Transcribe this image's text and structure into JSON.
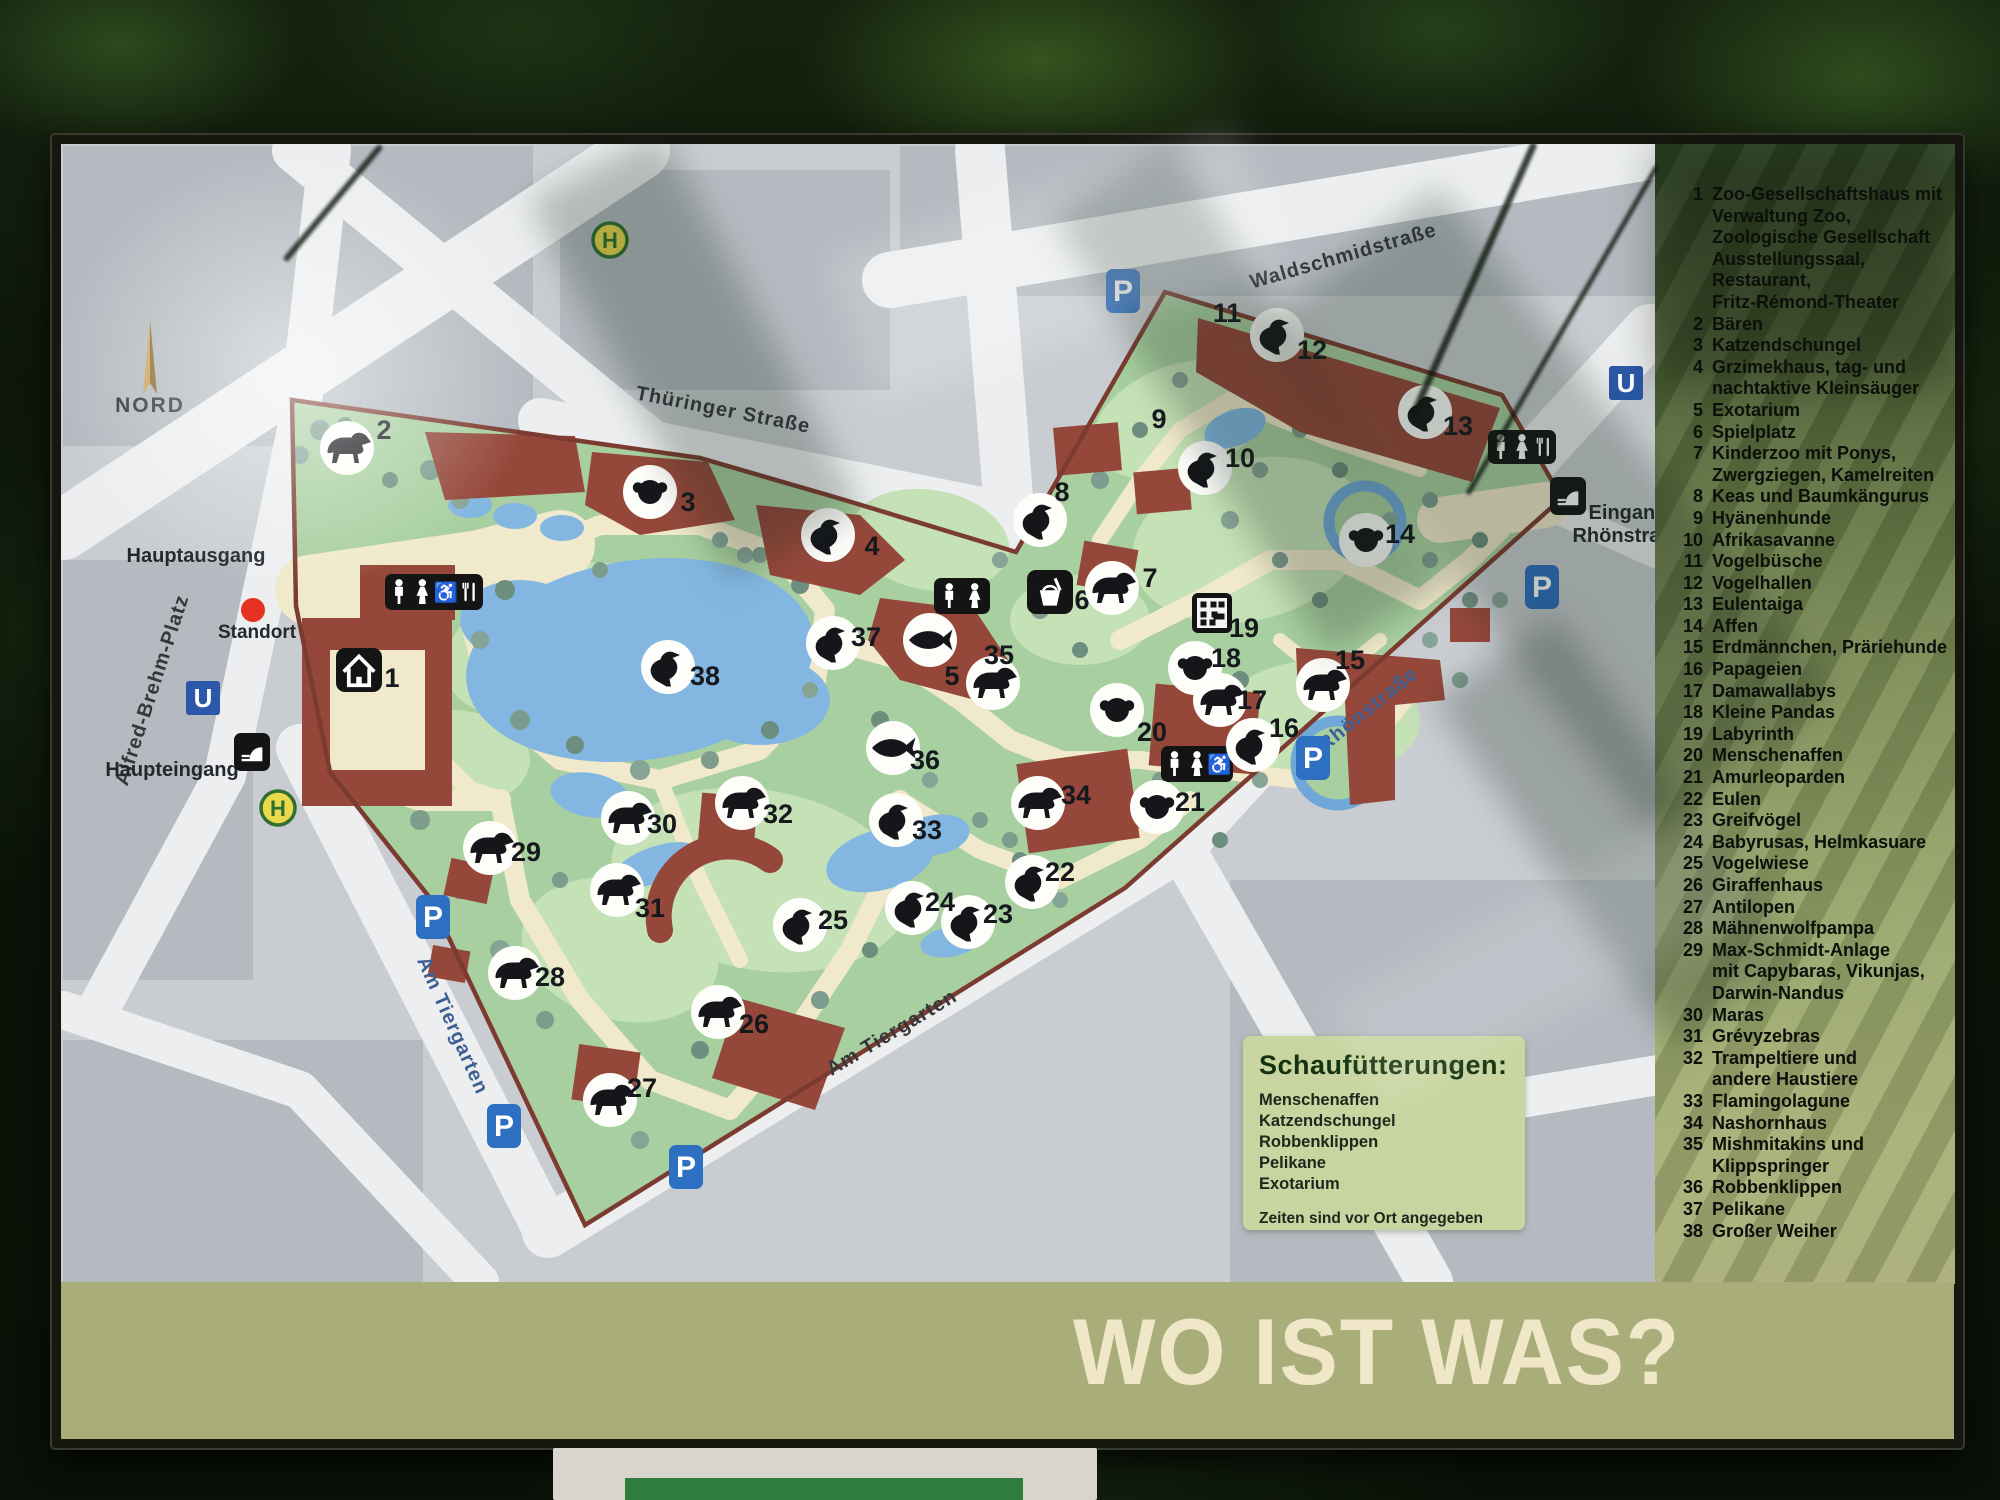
{
  "sign": {
    "banner_title": "WO IST WAS?",
    "legend": {
      "items": [
        {
          "n": "1",
          "lines": [
            "Zoo-Gesellschaftshaus mit",
            "Verwaltung Zoo,",
            "Zoologische Gesellschaft",
            "Ausstellungssaal,",
            "Restaurant,",
            "Fritz-Rémond-Theater"
          ]
        },
        {
          "n": "2",
          "lines": [
            "Bären"
          ]
        },
        {
          "n": "3",
          "lines": [
            "Katzendschungel"
          ]
        },
        {
          "n": "4",
          "lines": [
            "Grzimekhaus, tag- und",
            "nachtaktive Kleinsäuger"
          ]
        },
        {
          "n": "5",
          "lines": [
            "Exotarium"
          ]
        },
        {
          "n": "6",
          "lines": [
            "Spielplatz"
          ]
        },
        {
          "n": "7",
          "lines": [
            "Kinderzoo mit Ponys,",
            "Zwergziegen, Kamelreiten"
          ]
        },
        {
          "n": "8",
          "lines": [
            "Keas und Baumkängurus"
          ]
        },
        {
          "n": "9",
          "lines": [
            "Hyänenhunde"
          ]
        },
        {
          "n": "10",
          "lines": [
            "Afrikasavanne"
          ]
        },
        {
          "n": "11",
          "lines": [
            "Vogelbüsche"
          ]
        },
        {
          "n": "12",
          "lines": [
            "Vogelhallen"
          ]
        },
        {
          "n": "13",
          "lines": [
            "Eulentaiga"
          ]
        },
        {
          "n": "14",
          "lines": [
            "Affen"
          ]
        },
        {
          "n": "15",
          "lines": [
            "Erdmännchen, Präriehunde"
          ]
        },
        {
          "n": "16",
          "lines": [
            "Papageien"
          ]
        },
        {
          "n": "17",
          "lines": [
            "Damawallabys"
          ]
        },
        {
          "n": "18",
          "lines": [
            "Kleine Pandas"
          ]
        },
        {
          "n": "19",
          "lines": [
            "Labyrinth"
          ]
        },
        {
          "n": "20",
          "lines": [
            "Menschenaffen"
          ]
        },
        {
          "n": "21",
          "lines": [
            "Amurleoparden"
          ]
        },
        {
          "n": "22",
          "lines": [
            "Eulen"
          ]
        },
        {
          "n": "23",
          "lines": [
            "Greifvögel"
          ]
        },
        {
          "n": "24",
          "lines": [
            "Babyrusas, Helmkasuare"
          ]
        },
        {
          "n": "25",
          "lines": [
            "Vogelwiese"
          ]
        },
        {
          "n": "26",
          "lines": [
            "Giraffenhaus"
          ]
        },
        {
          "n": "27",
          "lines": [
            "Antilopen"
          ]
        },
        {
          "n": "28",
          "lines": [
            "Mähnenwolfpampa"
          ]
        },
        {
          "n": "29",
          "lines": [
            "Max-Schmidt-Anlage",
            "mit Capybaras, Vikunjas,",
            "Darwin-Nandus"
          ]
        },
        {
          "n": "30",
          "lines": [
            "Maras"
          ]
        },
        {
          "n": "31",
          "lines": [
            "Grévyzebras"
          ]
        },
        {
          "n": "32",
          "lines": [
            "Trampeltiere und",
            "andere Haustiere"
          ]
        },
        {
          "n": "33",
          "lines": [
            "Flamingolagune"
          ]
        },
        {
          "n": "34",
          "lines": [
            "Nashornhaus"
          ]
        },
        {
          "n": "35",
          "lines": [
            "Mishmitakins und",
            "Klippspringer"
          ]
        },
        {
          "n": "36",
          "lines": [
            "Robbenklippen"
          ]
        },
        {
          "n": "37",
          "lines": [
            "Pelikane"
          ]
        },
        {
          "n": "38",
          "lines": [
            "Großer Weiher"
          ]
        }
      ]
    },
    "feeding": {
      "title": "Schaufütterungen:",
      "items": [
        "Menschenaffen",
        "Katzendschungel",
        "Robbenklippen",
        "Pelikane",
        "Exotarium"
      ],
      "note": "Zeiten sind vor Ort angegeben"
    }
  },
  "map": {
    "compass": {
      "label": "NORD",
      "x": 150,
      "y": 412
    },
    "standort": {
      "label": "Standort",
      "x": 253,
      "y": 610
    },
    "entrance_labels": [
      {
        "id": "hauptausgang",
        "text": "Hauptausgang",
        "x": 196,
        "y": 562
      },
      {
        "id": "haupteingang",
        "text": "Haupteingang",
        "x": 172,
        "y": 776
      },
      {
        "id": "eingang-rhoenstrasse-1",
        "text": "Eingang",
        "x": 1628,
        "y": 519
      },
      {
        "id": "eingang-rhoenstrasse-2",
        "text": "Rhönstraße",
        "x": 1628,
        "y": 542
      }
    ],
    "street_labels": [
      {
        "id": "waldschmidstrasse",
        "text": "Waldschmidstraße",
        "x": 1345,
        "y": 262,
        "rot": -16,
        "color": "#34383d"
      },
      {
        "id": "thueringer-strasse",
        "text": "Thüringer Straße",
        "x": 722,
        "y": 416,
        "rot": 11,
        "color": "#34383d"
      },
      {
        "id": "rhoenstrasse",
        "text": "Rhönstraße",
        "x": 1372,
        "y": 714,
        "rot": -39,
        "color": "#3d5f93"
      },
      {
        "id": "am-tiergarten-west",
        "text": "Am Tiergarten",
        "x": 447,
        "y": 1028,
        "rot": 66,
        "color": "#3d5f93"
      },
      {
        "id": "am-tiergarten-sued",
        "text": "Am Tiergarten",
        "x": 895,
        "y": 1038,
        "rot": -31,
        "color": "#34383d"
      },
      {
        "id": "alfred-brehm-platz",
        "text": "Alfred-Brehm-Platz",
        "x": 158,
        "y": 692,
        "rot": -72,
        "color": "#34383d"
      }
    ],
    "markers": [
      {
        "n": "1",
        "icon": "zoo-house-icon",
        "style": "square",
        "x": 359,
        "y": 670,
        "lx": 392,
        "ly": 678
      },
      {
        "n": "2",
        "icon": "bear-icon",
        "x": 347,
        "y": 448,
        "lx": 384,
        "ly": 430
      },
      {
        "n": "3",
        "icon": "tiger-icon",
        "x": 650,
        "y": 492,
        "lx": 688,
        "ly": 502
      },
      {
        "n": "4",
        "icon": "bat-icon",
        "x": 828,
        "y": 535,
        "lx": 872,
        "ly": 546
      },
      {
        "n": "5",
        "icon": "fish-icon",
        "x": 930,
        "y": 640,
        "lx": 952,
        "ly": 676
      },
      {
        "n": "6",
        "icon": "playground-icon",
        "style": "square",
        "x": 1050,
        "y": 592,
        "lx": 1082,
        "ly": 600
      },
      {
        "n": "7",
        "icon": "pony-icon",
        "x": 1112,
        "y": 588,
        "lx": 1150,
        "ly": 578
      },
      {
        "n": "8",
        "icon": "kea-icon",
        "x": 1040,
        "y": 520,
        "lx": 1062,
        "ly": 492
      },
      {
        "n": "9",
        "icon": "wild-dog-icon",
        "style": "number-only",
        "x": 1159,
        "y": 419,
        "lx": 1159,
        "ly": 419
      },
      {
        "n": "10",
        "icon": "ostrich-icon",
        "x": 1205,
        "y": 468,
        "lx": 1240,
        "ly": 458
      },
      {
        "n": "11",
        "icon": "bird-bush-icon",
        "style": "number-only",
        "x": 1227,
        "y": 313,
        "lx": 1227,
        "ly": 313
      },
      {
        "n": "12",
        "icon": "ibis-icon",
        "x": 1277,
        "y": 335,
        "lx": 1312,
        "ly": 350
      },
      {
        "n": "13",
        "icon": "parrot-icon",
        "x": 1425,
        "y": 412,
        "lx": 1458,
        "ly": 426
      },
      {
        "n": "14",
        "icon": "monkey-icon",
        "x": 1366,
        "y": 540,
        "lx": 1400,
        "ly": 534
      },
      {
        "n": "15",
        "icon": "meerkat-icon",
        "x": 1323,
        "y": 685,
        "lx": 1350,
        "ly": 660
      },
      {
        "n": "16",
        "icon": "parrot-icon",
        "x": 1253,
        "y": 745,
        "lx": 1284,
        "ly": 728
      },
      {
        "n": "17",
        "icon": "wallaby-icon",
        "x": 1220,
        "y": 700,
        "lx": 1252,
        "ly": 700
      },
      {
        "n": "18",
        "icon": "red-panda-icon",
        "x": 1195,
        "y": 668,
        "lx": 1226,
        "ly": 658
      },
      {
        "n": "19",
        "icon": "labyrinth-icon",
        "style": "qr",
        "x": 1212,
        "y": 613,
        "lx": 1244,
        "ly": 628
      },
      {
        "n": "20",
        "icon": "gorilla-icon",
        "x": 1117,
        "y": 710,
        "lx": 1152,
        "ly": 732
      },
      {
        "n": "21",
        "icon": "leopard-icon",
        "x": 1157,
        "y": 807,
        "lx": 1190,
        "ly": 802
      },
      {
        "n": "22",
        "icon": "owl-icon",
        "x": 1032,
        "y": 882,
        "lx": 1060,
        "ly": 872
      },
      {
        "n": "23",
        "icon": "falcon-icon",
        "x": 968,
        "y": 922,
        "lx": 998,
        "ly": 914
      },
      {
        "n": "24",
        "icon": "cassowary-icon",
        "x": 912,
        "y": 908,
        "lx": 940,
        "ly": 902
      },
      {
        "n": "25",
        "icon": "crane-icon",
        "x": 800,
        "y": 925,
        "lx": 833,
        "ly": 920
      },
      {
        "n": "26",
        "icon": "giraffe-icon",
        "x": 718,
        "y": 1012,
        "lx": 754,
        "ly": 1024
      },
      {
        "n": "27",
        "icon": "antelope-icon",
        "x": 610,
        "y": 1100,
        "lx": 642,
        "ly": 1088
      },
      {
        "n": "28",
        "icon": "maned-wolf-icon",
        "x": 515,
        "y": 973,
        "lx": 550,
        "ly": 977
      },
      {
        "n": "29",
        "icon": "vicuna-icon",
        "x": 490,
        "y": 848,
        "lx": 526,
        "ly": 852
      },
      {
        "n": "30",
        "icon": "mara-icon",
        "x": 628,
        "y": 818,
        "lx": 662,
        "ly": 824
      },
      {
        "n": "31",
        "icon": "zebra-icon",
        "x": 617,
        "y": 890,
        "lx": 650,
        "ly": 908
      },
      {
        "n": "32",
        "icon": "camel-icon",
        "x": 742,
        "y": 803,
        "lx": 778,
        "ly": 814
      },
      {
        "n": "33",
        "icon": "flamingo-icon",
        "x": 896,
        "y": 820,
        "lx": 927,
        "ly": 830
      },
      {
        "n": "34",
        "icon": "rhino-icon",
        "x": 1038,
        "y": 803,
        "lx": 1076,
        "ly": 795
      },
      {
        "n": "35",
        "icon": "tapir-icon",
        "x": 993,
        "y": 683,
        "lx": 999,
        "ly": 655
      },
      {
        "n": "36",
        "icon": "seal-icon",
        "x": 893,
        "y": 748,
        "lx": 925,
        "ly": 760
      },
      {
        "n": "37",
        "icon": "pelican-icon",
        "x": 833,
        "y": 643,
        "lx": 866,
        "ly": 637
      },
      {
        "n": "38",
        "icon": "swan-icon",
        "x": 668,
        "y": 667,
        "lx": 705,
        "ly": 676
      }
    ],
    "facilities": [
      {
        "id": "wc-restaurant-main",
        "x": 385,
        "y": 574,
        "w": 98,
        "h": 36,
        "glyphs": [
          "man",
          "woman",
          "wheel",
          "fork"
        ]
      },
      {
        "id": "wc-exotarium",
        "x": 934,
        "y": 578,
        "w": 56,
        "h": 36,
        "glyphs": [
          "man",
          "woman"
        ]
      },
      {
        "id": "wc-sued",
        "x": 1161,
        "y": 746,
        "w": 72,
        "h": 36,
        "glyphs": [
          "man",
          "woman",
          "wheel"
        ]
      },
      {
        "id": "wc-restaurant-ost",
        "x": 1488,
        "y": 430,
        "w": 68,
        "h": 34,
        "glyphs": [
          "man",
          "woman",
          "fork"
        ]
      },
      {
        "id": "tor-ost",
        "x": 1550,
        "y": 477,
        "w": 36,
        "h": 38,
        "glyphs": [
          "gate"
        ]
      },
      {
        "id": "tor-haupteingang",
        "x": 234,
        "y": 733,
        "w": 36,
        "h": 38,
        "glyphs": [
          "gate"
        ]
      }
    ],
    "transit": [
      {
        "type": "P",
        "x": 1123,
        "y": 291
      },
      {
        "type": "P",
        "x": 433,
        "y": 917
      },
      {
        "type": "P",
        "x": 504,
        "y": 1126
      },
      {
        "type": "P",
        "x": 686,
        "y": 1167
      },
      {
        "type": "P",
        "x": 1313,
        "y": 758
      },
      {
        "type": "P",
        "x": 1542,
        "y": 587
      },
      {
        "type": "U",
        "x": 203,
        "y": 698
      },
      {
        "type": "U",
        "x": 1626,
        "y": 383
      },
      {
        "type": "H",
        "x": 610,
        "y": 240
      },
      {
        "type": "H",
        "x": 278,
        "y": 808
      }
    ],
    "colors": {
      "park_green": "#a8cfa0",
      "lawn_green": "#c5e1b6",
      "water_blue": "#83b7e2",
      "building_brown": "#95483a",
      "path_cream": "#f0e9cb",
      "road_white": "#eceeef",
      "block_gray": "#b4bac0",
      "map_gray": "#c9cdd1",
      "border_brown": "#7c3b30",
      "p_blue": "#2d6fc0",
      "u_blue": "#2b58a8",
      "h_yellow": "#ead94b",
      "h_green": "#2f7031",
      "band_olive": "#a9ad79",
      "banner_cream": "#efe7c8",
      "standort_red": "#e63222"
    }
  }
}
